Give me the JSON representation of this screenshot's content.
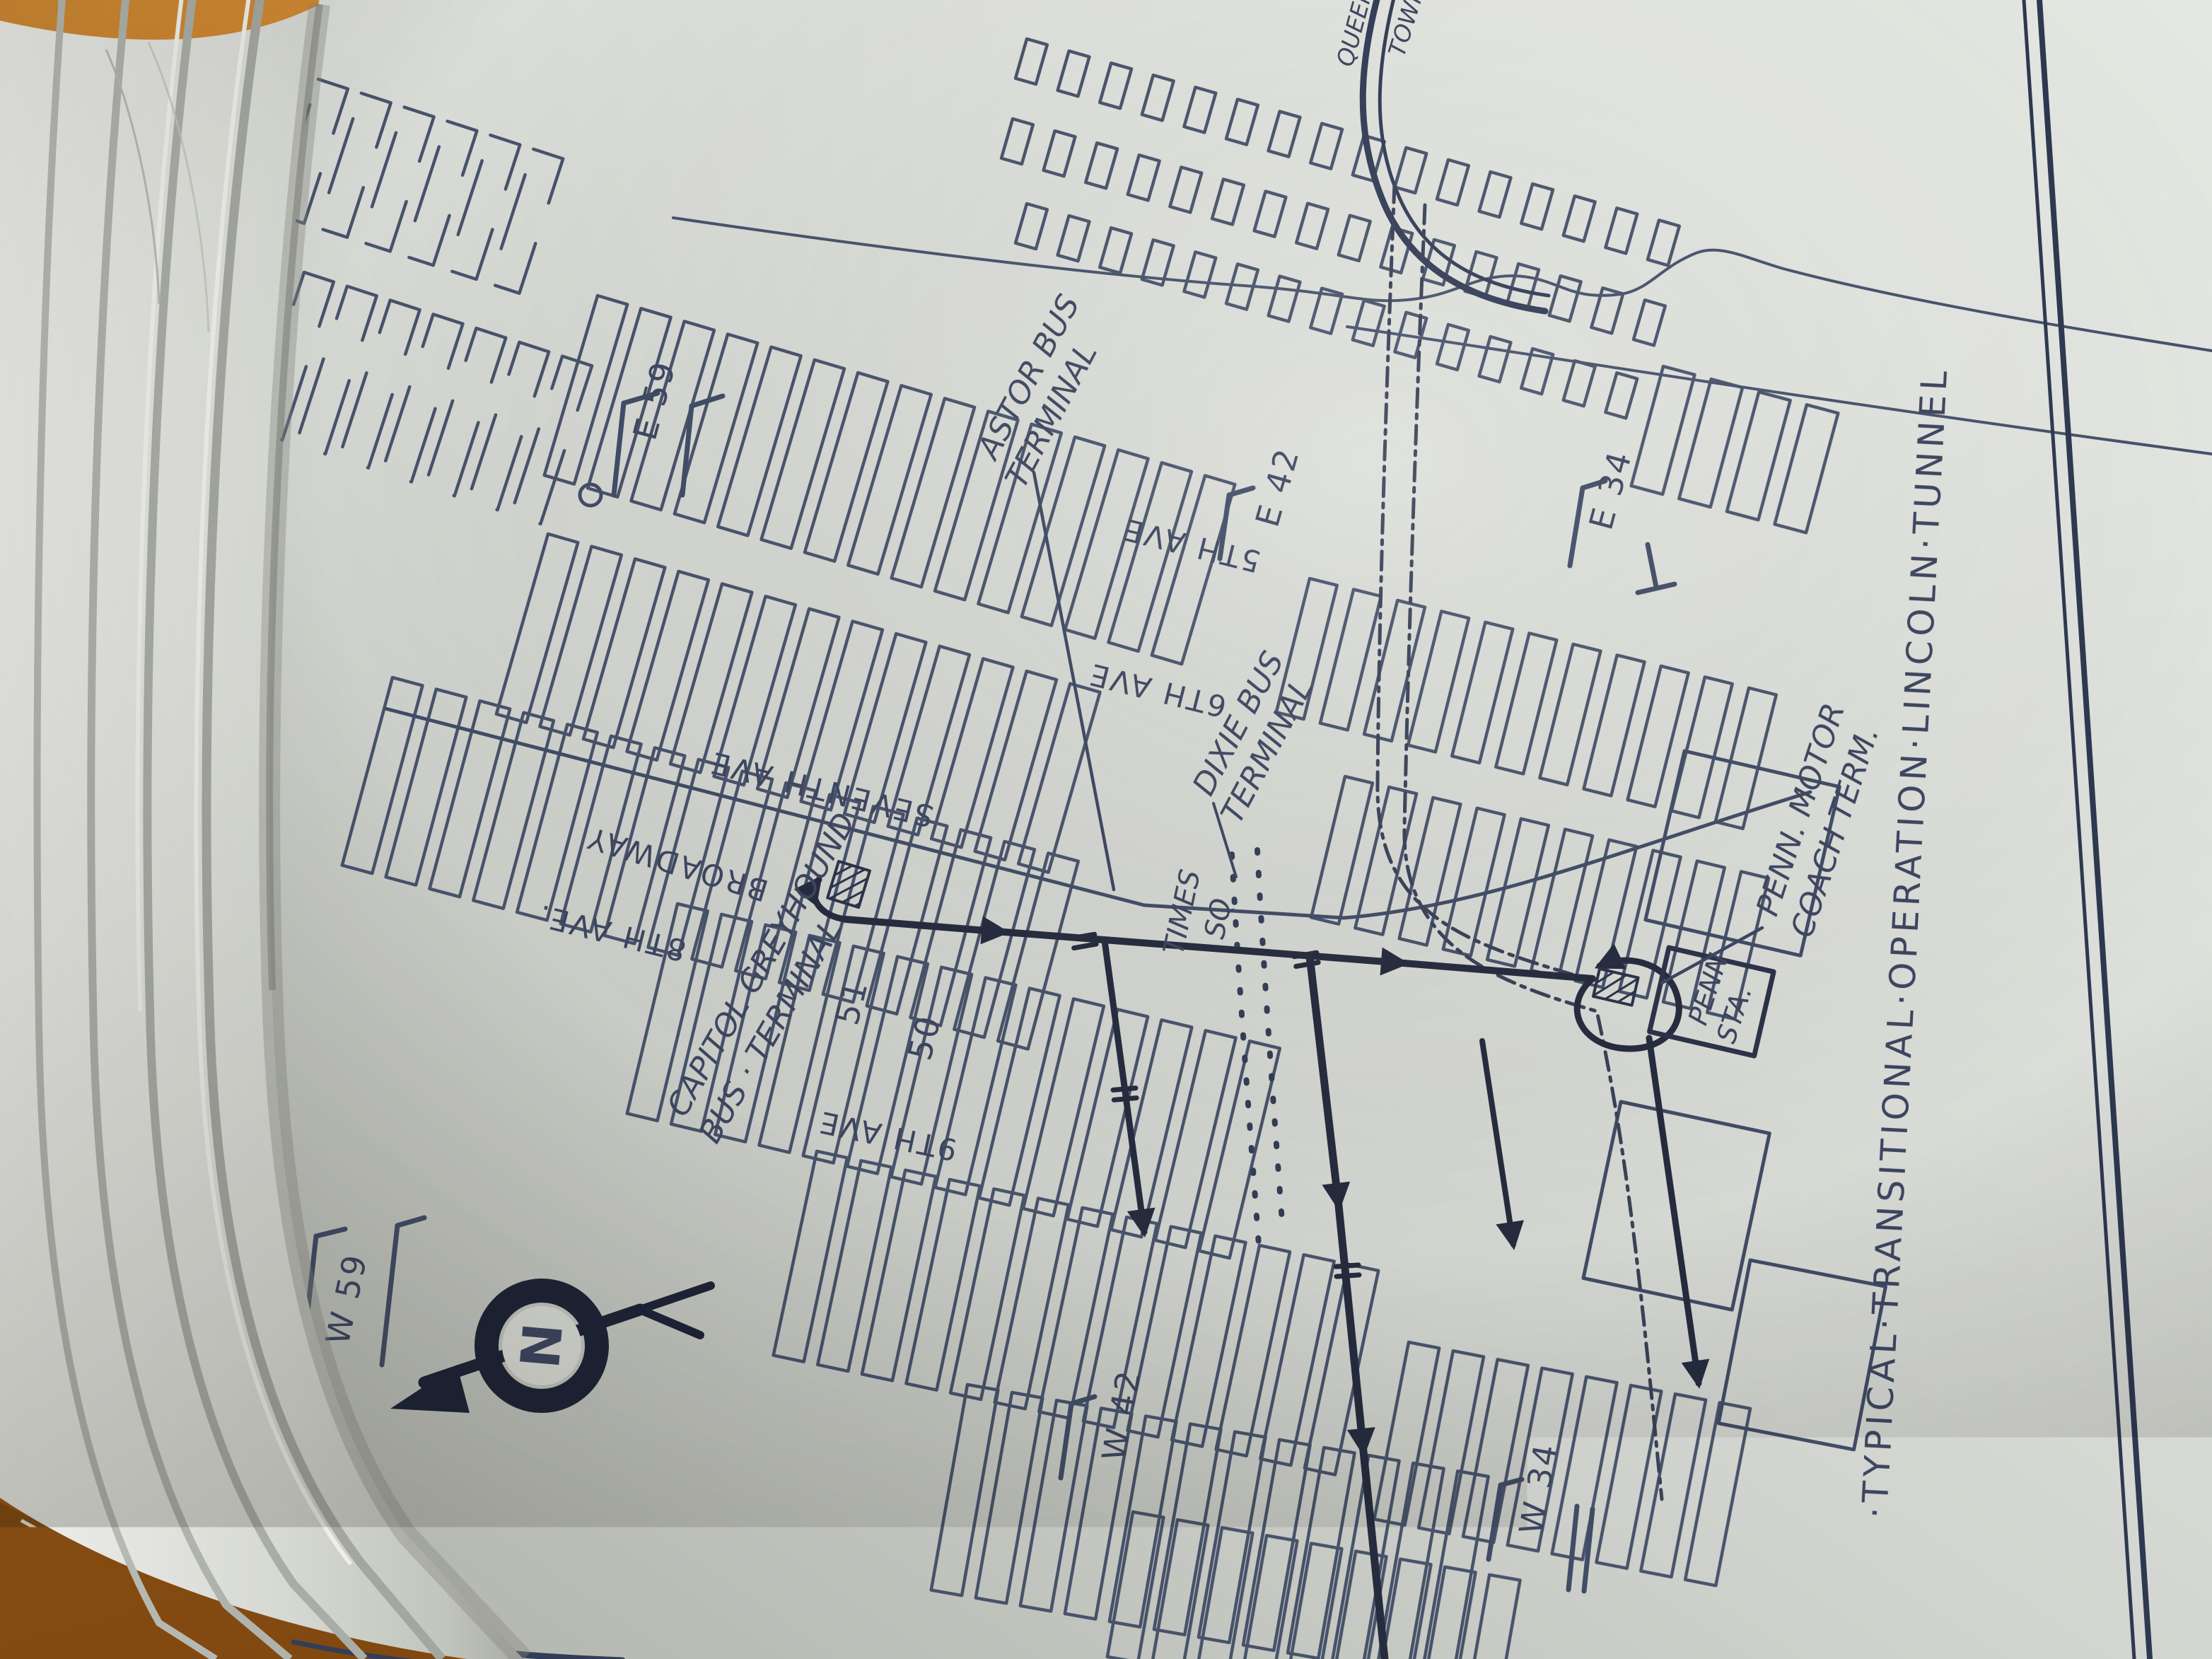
{
  "map": {
    "title": "·TYPICAL·TRANSITIONAL·OPERATION·LINCOLN·TUNNEL",
    "credit": "Map Makers",
    "compass": {
      "north_letter": "N"
    },
    "tunnel_labels": {
      "line1": "QUEENS",
      "line2": "TOWN"
    },
    "streets": {
      "e59": "E 59",
      "e42": "E 42",
      "e34": "E 34",
      "w59": "W 59",
      "w42": "W 42",
      "w34": "W 34",
      "st51": "51",
      "st50": "50"
    },
    "avenues": {
      "ave5": "5TH AVE",
      "ave6": "6TH AVE",
      "ave7": "SEVENTH AVE",
      "broadway": "BROADWAY",
      "ave8": "8TH AVE.",
      "ave9": "9TH AVE"
    },
    "places": {
      "times_sq_line1": "TIMES",
      "times_sq_line2": "SQ",
      "astor_line1": "ASTOR BUS",
      "astor_line2": "TERMINAL",
      "dixie_line1": "DIXIE BUS",
      "dixie_line2": "TERMINAL",
      "capitol_line1": "CAPITOL GREYHOUND",
      "capitol_line2": "BUS · TERMINAL",
      "penn_motor_line1": "PENN. MOTOR",
      "penn_motor_line2": "COACH TERM.",
      "penn_sta_line1": "PENN",
      "penn_sta_line2": "STA."
    },
    "colors": {
      "ink": "#3d4660",
      "route": "#262c3e",
      "paper": "#d7d9d3",
      "wood": "#b4691e"
    }
  }
}
